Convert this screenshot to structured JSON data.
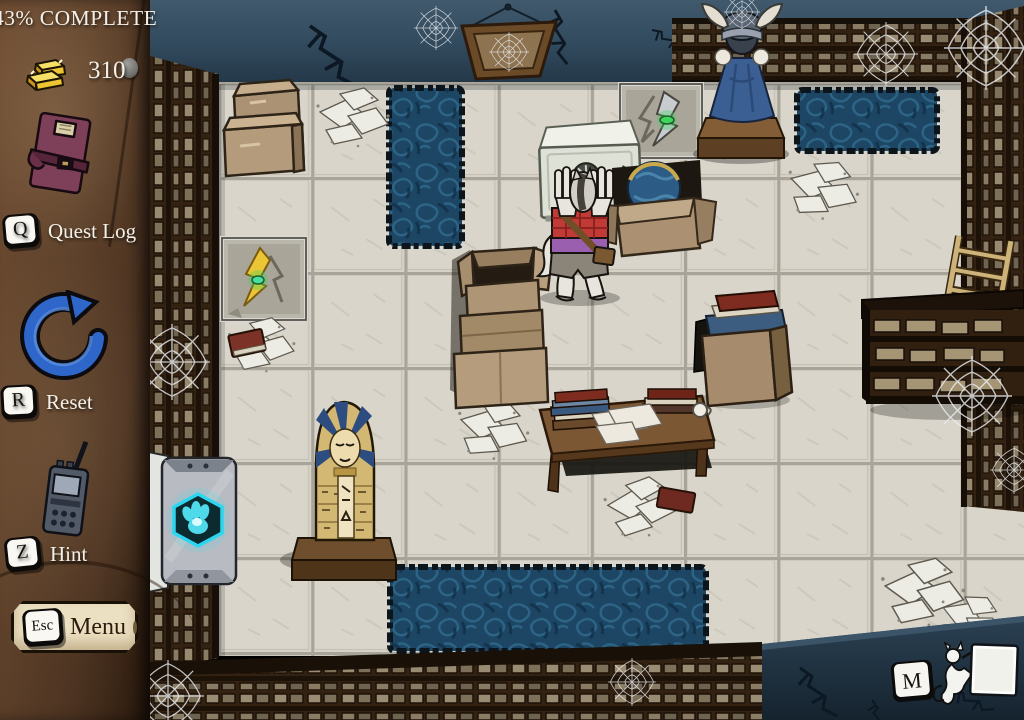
{
  "hud": {
    "progress_label": "43% COMPLETE",
    "gold": {
      "amount": "310",
      "icon": "gold-bars-icon"
    },
    "quest_log": {
      "key": "Q",
      "label": "Quest Log",
      "icon": "journal-icon"
    },
    "reset": {
      "key": "R",
      "label": "Reset",
      "icon": "reset-arrow-icon"
    },
    "hint": {
      "key": "Z",
      "label": "Hint",
      "icon": "walkie-talkie-icon"
    },
    "menu": {
      "key": "Esc",
      "label": "Menu"
    },
    "map": {
      "key": "M"
    }
  },
  "scene": {
    "objects": [
      "viking-statue",
      "hanging-frame",
      "switch-plate-silver",
      "switch-plate-gold",
      "safe",
      "werewolf-character",
      "globe-box",
      "box-stack-top-left",
      "box-stack-center",
      "box-of-books",
      "table-with-books",
      "sarcophagus",
      "exit-door",
      "ladder",
      "right-shelf-unit",
      "blue-rugs",
      "paper-piles",
      "spiderwebs"
    ]
  },
  "colors": {
    "hud_text": "#f4f0e7",
    "gold": "#eec433",
    "accent_cyan": "#35dff2",
    "emblem_green": "#3fd45c",
    "rug_blue": "#1c4663",
    "wall_blue": "#31495c",
    "floor_tile": "#d6d2c6",
    "shelf_wood": "#332212",
    "sidebar_leather": "#5c3f29",
    "plaque_cream": "#ece0c2"
  }
}
